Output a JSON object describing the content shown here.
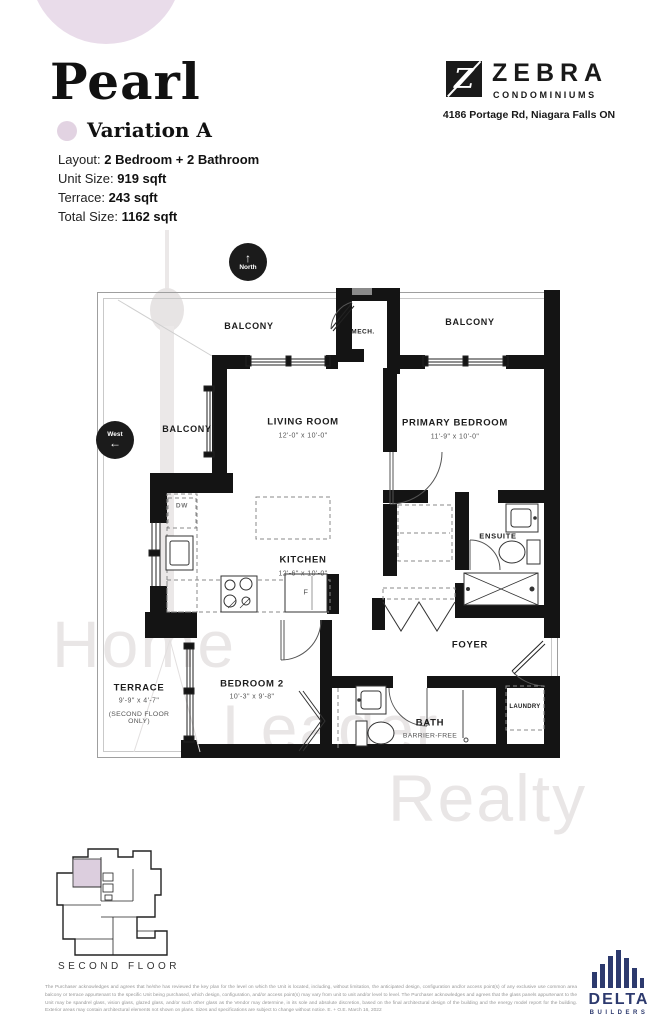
{
  "header": {
    "title": "Pearl",
    "variation": "Variation A",
    "specs": [
      {
        "label": "Layout: ",
        "value": "2 Bedroom + 2 Bathroom"
      },
      {
        "label": "Unit Size: ",
        "value": "919 sqft"
      },
      {
        "label": "Terrace: ",
        "value": "243 sqft"
      },
      {
        "label": "Total Size: ",
        "value": "1162 sqft"
      }
    ],
    "accent_color": "#e2d3e2"
  },
  "brand": {
    "logo_letter": "Z",
    "name": "ZEBRA",
    "subtitle": "CONDOMINIUMS",
    "address": "4186 Portage Rd, Niagara Falls ON"
  },
  "compass": {
    "north": "North",
    "north_arrow": "↑",
    "west": "West",
    "west_arrow": "←"
  },
  "plan": {
    "balcony_top_left": "BALCONY",
    "balcony_top_right": "BALCONY",
    "balcony_left": "BALCONY",
    "mech": "MECH.",
    "living": {
      "name": "LIVING ROOM",
      "dims": "12'-0\" x 10'-0\""
    },
    "primary": {
      "name": "PRIMARY BEDROOM",
      "dims": "11'-9\" x 10'-0\""
    },
    "kitchen": {
      "name": "KITCHEN",
      "dims": "12'-6\" x 10'-0\""
    },
    "ensuite": {
      "name": "ENSUITE"
    },
    "foyer": {
      "name": "FOYER"
    },
    "terrace": {
      "name": "TERRACE",
      "dims": "9'-9\" x 4'-7\"",
      "note": "(SECOND FLOOR ONLY)"
    },
    "bedroom2": {
      "name": "BEDROOM 2",
      "dims": "10'-3\" x 9'-8\""
    },
    "bath": {
      "name": "BATH",
      "note": "BARRIER-FREE"
    },
    "laundry": {
      "name": "LAUNDRY"
    },
    "appliances": {
      "dw": "DW",
      "fridge": "F"
    }
  },
  "watermark": {
    "words": [
      "Home",
      "Leader",
      "Realty"
    ]
  },
  "keyplan": {
    "caption": "SECOND FLOOR",
    "highlight_color": "#dccede"
  },
  "disclaimer": "The Purchaser acknowledges and agrees that he/she has reviewed the key plan for the level on which the Unit is located, including, without limitation, the anticipated design, configuration and/or access point(s) of any exclusive use common area balcony or terrace appurtenant to the specific Unit being purchased, which design, configuration, and/or access point(s) may vary from unit to unit and/or level to level. The Purchaser acknowledges and agrees that the glass panels appurtenant to the Unit may be spandrel glass, vision glass, glazed glass, and/or such other glass as the Vendor may determine, in its sole and absolute discretion, based on the final architectural design of the building and the energy model report for the building. Exterior areas may contain architectural elements not shown on plans. Sizes and specifications are subject to change without notice. E. + O.E. March 16, 2022",
  "builder": {
    "name": "DELTA",
    "subtitle": "BUILDERS",
    "color": "#2d3a6e"
  }
}
